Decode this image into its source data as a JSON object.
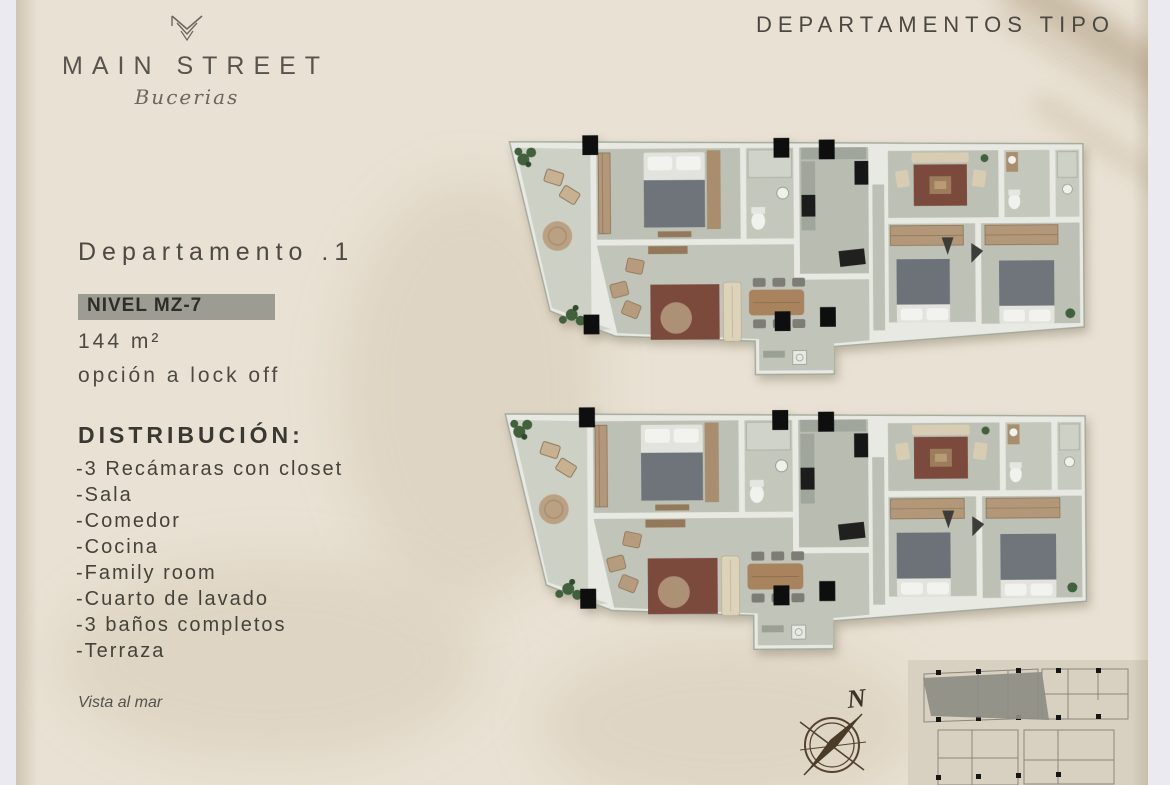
{
  "header": {
    "label": "DEPARTAMENTOS TIPO"
  },
  "logo": {
    "name": "MAIN STREET",
    "script": "Bucerias"
  },
  "unit": {
    "title": "Departamento .1",
    "level": "NIVEL MZ-7",
    "area": "144 m²",
    "option": "opción a lock off",
    "view_note": "Vista al mar"
  },
  "distribution": {
    "heading": "DISTRIBUCIÓN:",
    "items": [
      "-3 Recámaras con closet",
      "-Sala",
      "-Comedor",
      "-Cocina",
      "-Family room",
      "-Cuarto de lavado",
      "-3 baños completos",
      "-Terraza"
    ]
  },
  "compass": {
    "north": "N"
  },
  "colors": {
    "background": "#e9e1d3",
    "text": "#4a4742",
    "badge_bg": "#9d9c93",
    "plan_floor": "#bfc3b8",
    "plan_wall": "#e7e9e2",
    "wood": "#b29878",
    "rug": "#7b4a3c",
    "plant": "#41603c",
    "column": "#0e0e0e",
    "compass": "#4f3e2f",
    "keyplan_highlight": "#8e8d86"
  }
}
